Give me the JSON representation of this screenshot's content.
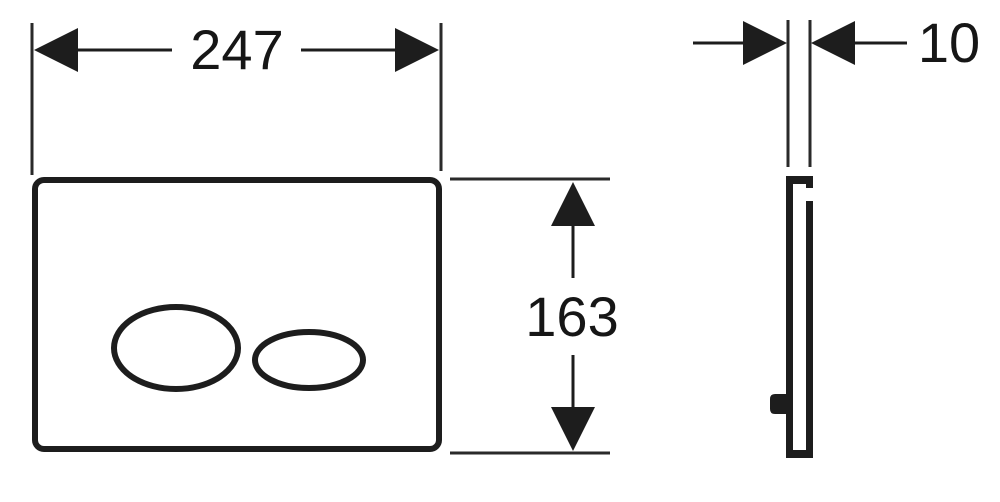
{
  "diagram": {
    "dimensions": {
      "width_label": "247",
      "height_label": "163",
      "thickness_label": "10"
    },
    "colors": {
      "line": "#1d1d1d",
      "background": "#ffffff"
    }
  }
}
